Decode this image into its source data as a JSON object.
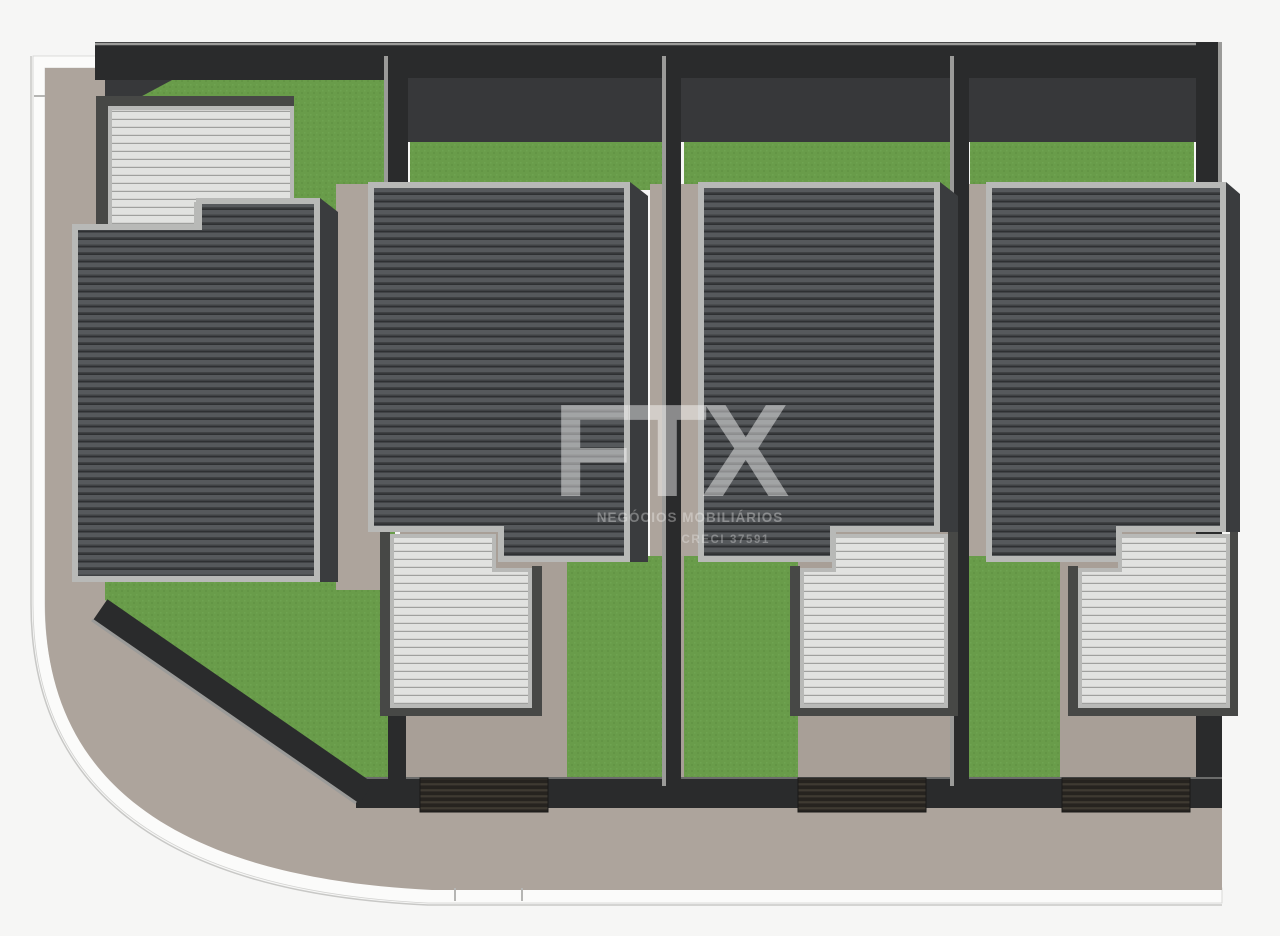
{
  "watermark": {
    "brand": "FTX",
    "tagline": "NEGÓCIOS MOBILIÁRIOS",
    "license": "CRECI 37591"
  },
  "scene": {
    "type": "top-view 3D site plan render of a residential condominium",
    "street_corner": "rounded sidewalk corner at bottom-left",
    "units": [
      {
        "id": "unit-1",
        "position": "corner lot, left",
        "main_roof": "dark ribbed gable roof",
        "carport_roof": "light slatted carport at top-left",
        "lawn": "wraparound lawn",
        "gate": "none visible"
      },
      {
        "id": "unit-2",
        "position": "second lot",
        "main_roof": "dark ribbed gable roof",
        "carport_roof": "light slatted carport at bottom-left",
        "lawn": "back lawn and front lawn",
        "gate": "dark slatted street gate at driveway"
      },
      {
        "id": "unit-3",
        "position": "third lot",
        "main_roof": "dark ribbed gable roof",
        "carport_roof": "light slatted carport at bottom-right",
        "lawn": "back lawn and front lawn",
        "gate": "dark slatted street gate at driveway"
      },
      {
        "id": "unit-4",
        "position": "right lot",
        "main_roof": "dark ribbed gable roof",
        "carport_roof": "light slatted carport at bottom-right",
        "lawn": "back lawn and front lawn",
        "gate": "dark slatted street gate at driveway"
      }
    ]
  },
  "colors": {
    "background": "#f6f6f5",
    "pavement": "#ada49c",
    "driveway": "#a89f97",
    "grass": "#699c4a",
    "grass_dark": "#5e8f41",
    "grass_light": "#76ab57",
    "roof_band": "#56595c",
    "roof_mid": "#404244",
    "roof_groove": "#2e3032",
    "roof_border": "#b8b9b7",
    "roof_side": "#3a3c3e",
    "slat_base": "#e1e2e0",
    "slat_line": "#9fa09e",
    "garage_frame": "#474846",
    "wall": "#2a2b2c",
    "wall_face": "#37383a",
    "wall_cap": "#9b9b99",
    "gate_dark": "#26231f",
    "gate_light": "#3f3a32",
    "curb": "#fbfbfa",
    "curb_line": "#c8c8c6",
    "watermark_brand": "rgba(255,255,255,0.45)",
    "watermark_tag": "rgba(255,255,255,0.33)",
    "watermark_lic": "rgba(255,255,255,0.30)"
  }
}
